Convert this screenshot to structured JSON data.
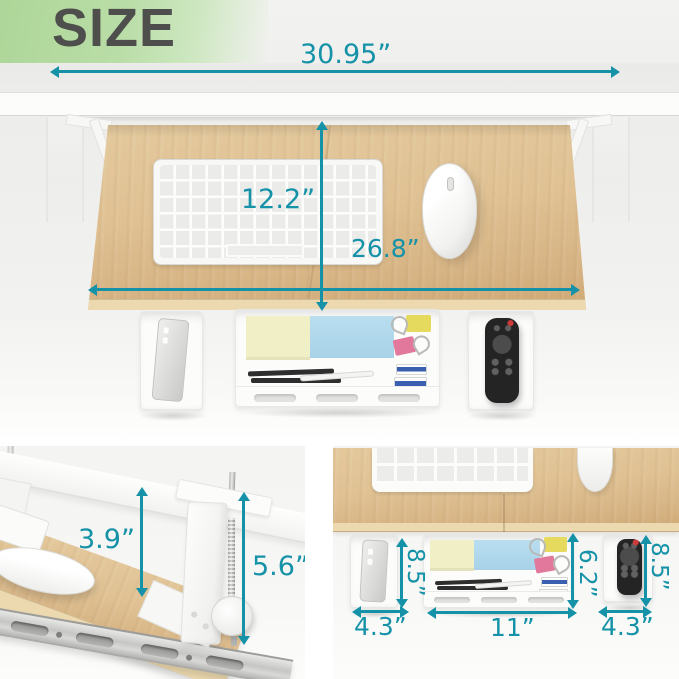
{
  "title": "SIZE",
  "colors": {
    "accent": "#1592a8",
    "banner_green": "#aed699",
    "title_text": "#4e4e4c",
    "wood": "#dfc193",
    "wood_edge": "#ecd9af",
    "desk_white": "#fcfcfb",
    "note_yellow": "#f0efc6",
    "note_blue": "#b9def0",
    "clip_yellow": "#e5da5e",
    "clip_pink": "#e2799c",
    "remote_black": "#242424"
  },
  "overview": {
    "desk_width": "30.95”",
    "tray_depth": "12.2”",
    "tray_width": "26.8”"
  },
  "clamp_detail": {
    "clearance": "3.9”",
    "clamp_height": "5.6”"
  },
  "underside_detail": {
    "left_tray_depth": "8.5”",
    "left_tray_width": "4.3”",
    "organizer_depth": "6.2”",
    "organizer_width": "11”",
    "right_tray_depth": "8.5”",
    "right_tray_width": "4.3”"
  },
  "depicted_objects": [
    "desk",
    "clamp-on keyboard tray",
    "keyboard",
    "wireless mouse",
    "under-desk side tray",
    "phone",
    "organizer tray",
    "sticky notes",
    "binder clips",
    "pens",
    "erasers",
    "remote control",
    "slide rail",
    "c-clamp"
  ]
}
